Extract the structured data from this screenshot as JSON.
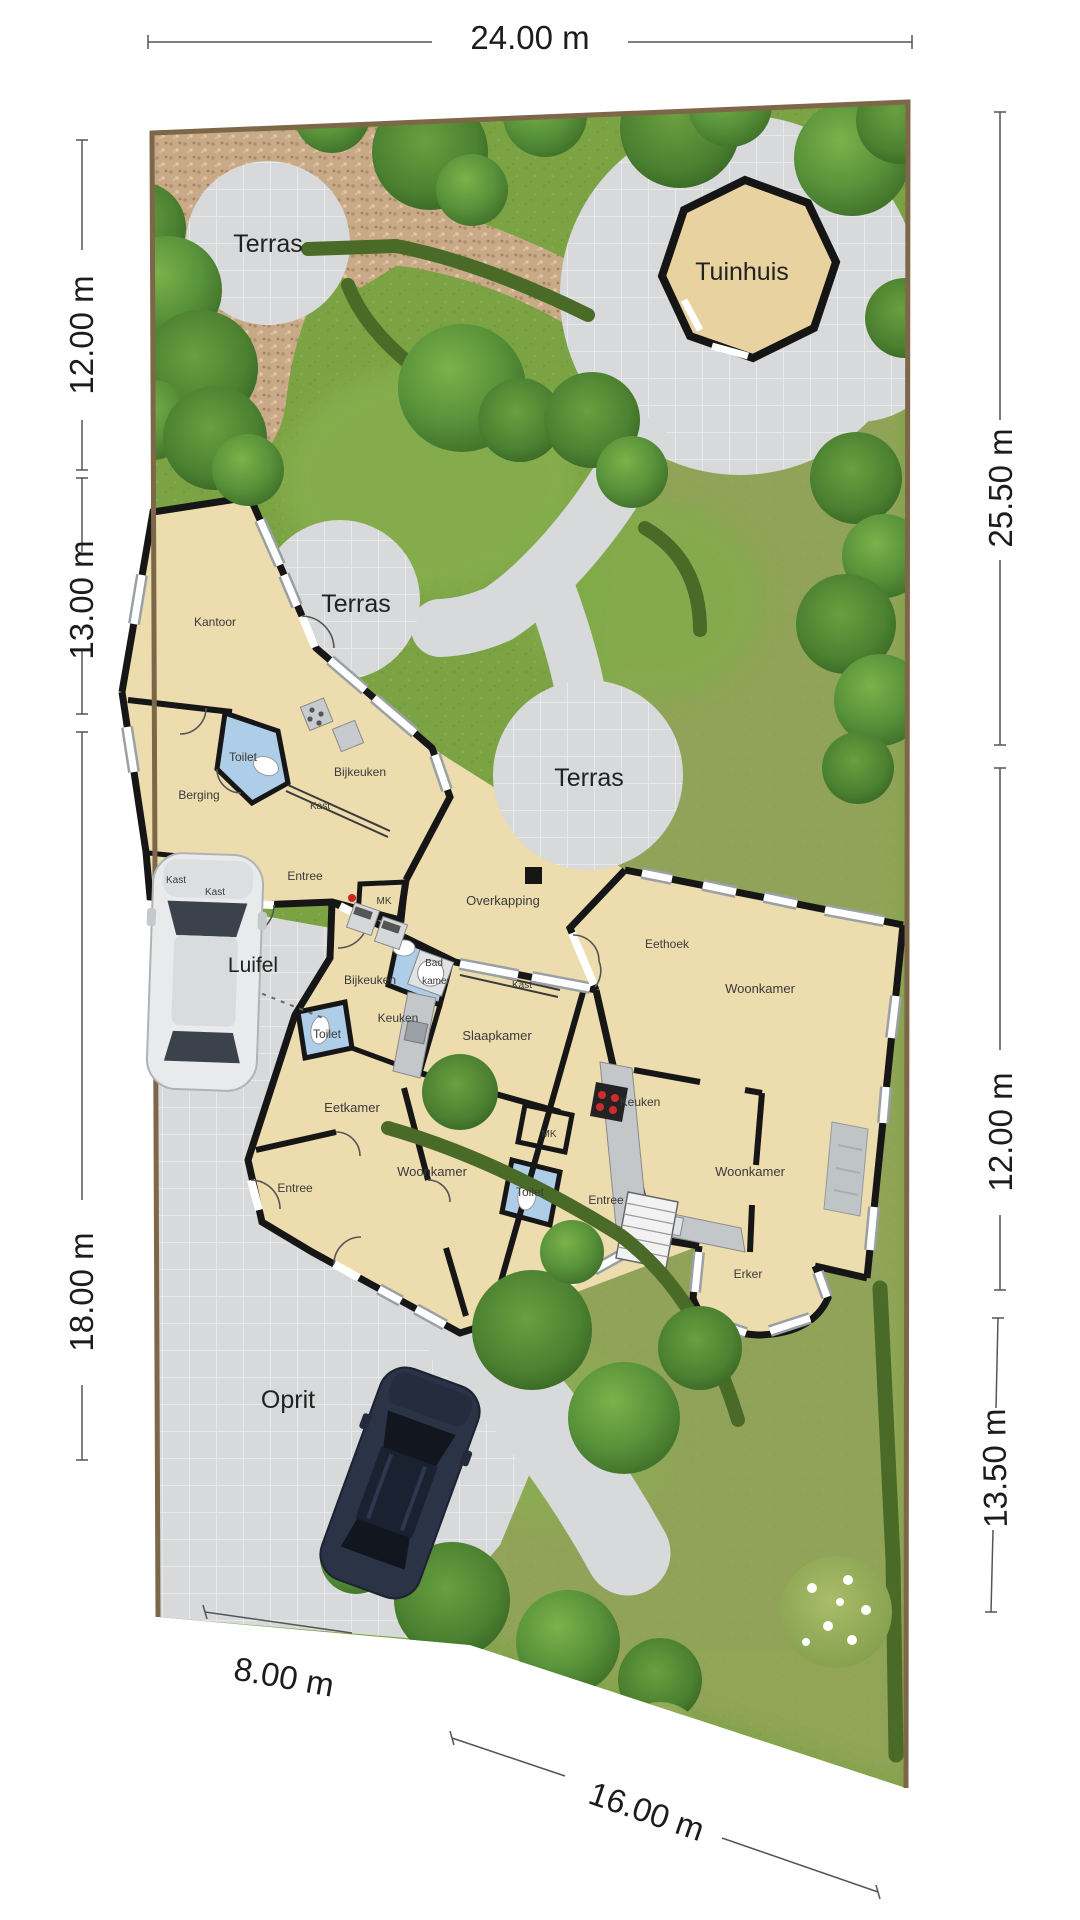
{
  "plan_title": "Site plan with floorplan (Dutch)",
  "labels": {
    "dim_top": "24.00 m",
    "dim_left_top": "12.00 m",
    "dim_left_mid": "13.00 m",
    "dim_left_bottom": "18.00 m",
    "dim_right_top": "25.50 m",
    "dim_right_mid": "12.00 m",
    "dim_right_bottom": "13.50 m",
    "dim_bottom_left": "8.00 m",
    "dim_bottom_right": "16.00 m",
    "terras": "Terras",
    "tuinhuis": "Tuinhuis",
    "luifel": "Luifel",
    "oprit": "Oprit",
    "overkapping": "Overkapping",
    "kantoor": "Kantoor",
    "toilet": "Toilet",
    "berging": "Berging",
    "bijkeuken": "Bijkeuken",
    "kast": "Kast",
    "entree": "Entree",
    "mk": "MK",
    "eethoek": "Eethoek",
    "woonkamer": "Woonkamer",
    "badkamer_l1": "Bad",
    "badkamer_l2": "kamer",
    "keuken": "Keuken",
    "slaapkamer": "Slaapkamer",
    "eetkamer": "Eetkamer",
    "erker": "Erker"
  },
  "colors": {
    "grass": "#7ba344",
    "grass_light": "#85ae4e",
    "grass_olive": "#98a45e",
    "gravel": "#c9aa88",
    "paving": "#d7d9da",
    "floor": "#ecdcae",
    "wall": "#161616",
    "wet_room": "#aecde8",
    "hedge": "#4a6a27",
    "tree_dark": "#3f7029",
    "tree_light": "#7cb24a",
    "plot_border": "#7d6748",
    "car_dark": "#2b3347",
    "car_light": "#e9eaec"
  }
}
